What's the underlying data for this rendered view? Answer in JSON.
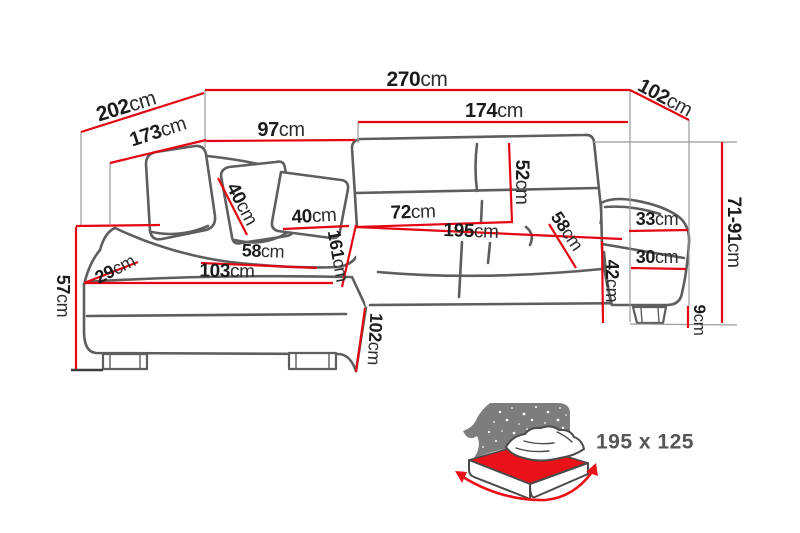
{
  "dims": {
    "width_total": {
      "num": "270",
      "unit": "cm"
    },
    "depth_left_total": {
      "num": "202",
      "unit": "cm"
    },
    "chaise_outer_length": {
      "num": "173",
      "unit": "cm"
    },
    "back_left_width": {
      "num": "97",
      "unit": "cm"
    },
    "width_right": {
      "num": "174",
      "unit": "cm"
    },
    "right_side_depth": {
      "num": "102",
      "unit": "cm"
    },
    "pillow_left_width": {
      "num": "40",
      "unit": "cm"
    },
    "pillow_right_width": {
      "num": "40",
      "unit": "cm"
    },
    "backrest_height": {
      "num": "52",
      "unit": "cm"
    },
    "seat_depth": {
      "num": "72",
      "unit": "cm"
    },
    "sleeping_length": {
      "num": "195",
      "unit": "cm"
    },
    "seat_depth_right": {
      "num": "58",
      "unit": "cm"
    },
    "armrest_top_width": {
      "num": "33",
      "unit": "cm"
    },
    "armrest_front_width": {
      "num": "30",
      "unit": "cm"
    },
    "base_front_height": {
      "num": "42",
      "unit": "cm"
    },
    "leg_height": {
      "num": "9",
      "unit": "cm"
    },
    "total_height_range": {
      "num": "71-91",
      "unit": "cm"
    },
    "arm_left_width": {
      "num": "29",
      "unit": "cm"
    },
    "seat_depth_left": {
      "num": "58",
      "unit": "cm"
    },
    "chaise_front_width": {
      "num": "103",
      "unit": "cm"
    },
    "chaise_inner_length": {
      "num": "161",
      "unit": "cm"
    },
    "chaise_side_width": {
      "num": "102",
      "unit": "cm"
    },
    "seat_height": {
      "num": "57",
      "unit": "cm"
    }
  },
  "sleeping_area": {
    "size_label": "195 x 125"
  },
  "icons": {
    "sofa_bed_icon": "bed-with-starry-headboard"
  },
  "colors": {
    "dimension_red": "#e30613",
    "outline_gray": "#5e5e5e",
    "extension_gray": "#9a9a9a",
    "label_dark": "#1c1c1c",
    "icon_gray": "#7d7d7d",
    "icon_red": "#ea1118",
    "icon_text": "#565656"
  }
}
